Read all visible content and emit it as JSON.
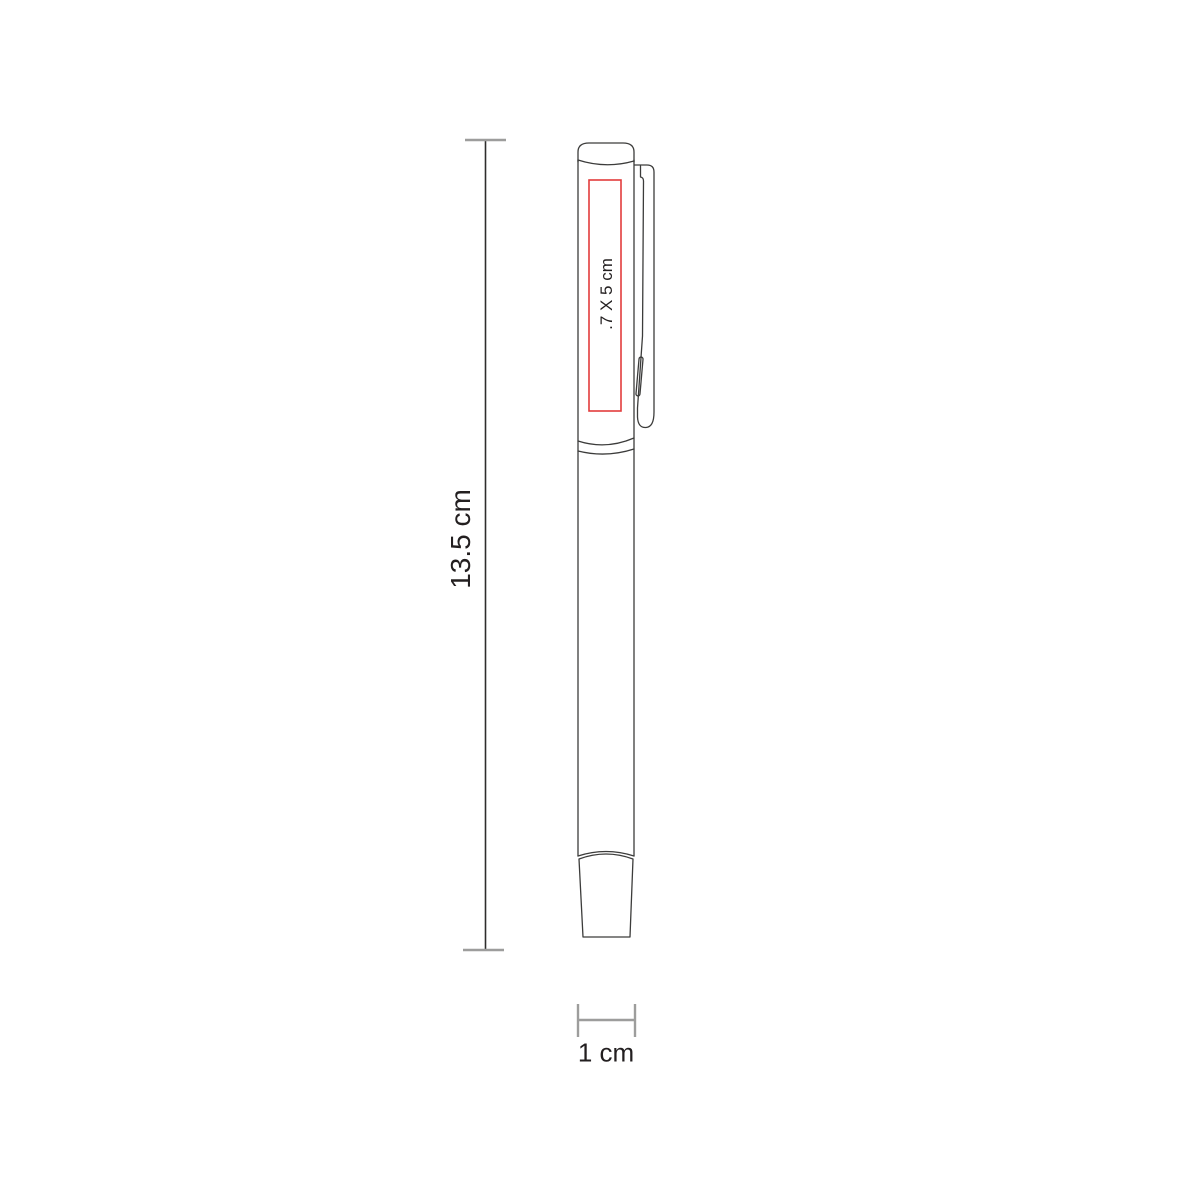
{
  "diagram": {
    "type": "product-dimension-drawing",
    "product": "capped-pen-side-view",
    "dimensions": {
      "height": {
        "label": "13.5 cm"
      },
      "width": {
        "label": "1 cm"
      },
      "print_area": {
        "label": ".7 X 5 cm"
      }
    },
    "colors": {
      "outline": "#3c3c3b",
      "dimension_line": "#2e2d2c",
      "dimension_tick": "#9d9d9c",
      "print_area_border": "#e23c3c",
      "label_text": "#231f20"
    }
  }
}
